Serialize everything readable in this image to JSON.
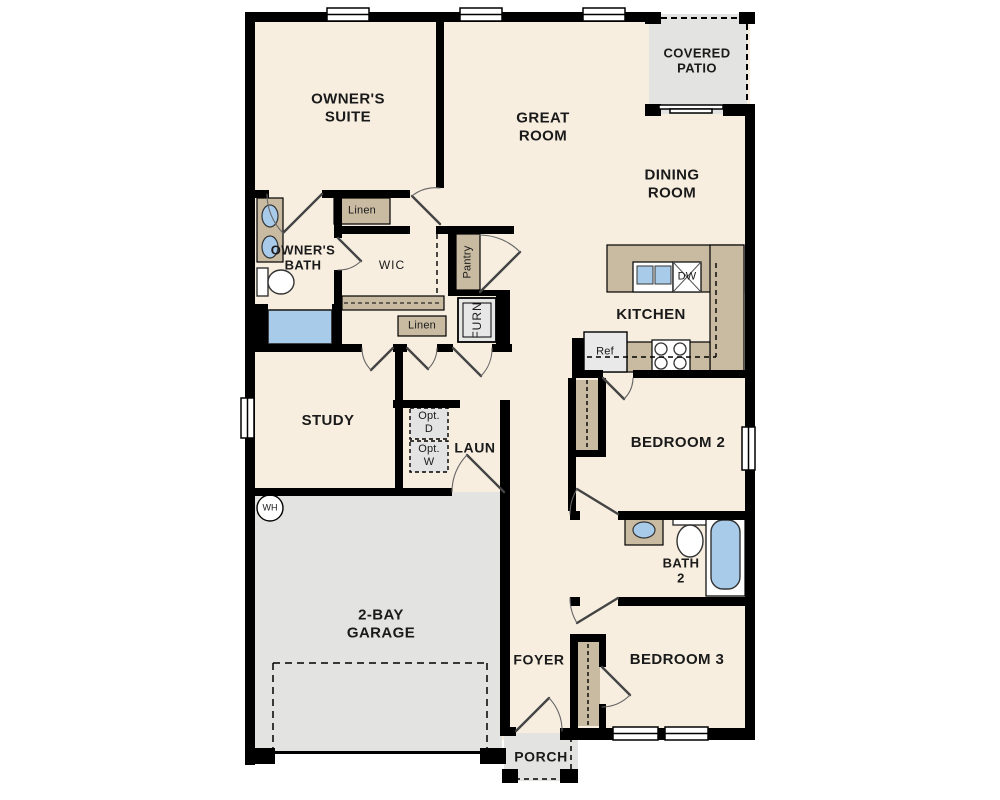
{
  "title": "single-story floor plan",
  "labels": {
    "owners_suite": "OWNER'S\nSUITE",
    "great_room": "GREAT\nROOM",
    "covered_patio": "COVERED\nPATIO",
    "dining_room": "DINING\nROOM",
    "owners_bath": "OWNER'S\nBATH",
    "linen_1": "Linen",
    "wic": "WIC",
    "pantry": "Pantry",
    "furn": "FURN",
    "linen_2": "Linen",
    "kitchen": "KITCHEN",
    "dw": "DW",
    "ref": "Ref",
    "study": "STUDY",
    "opt_d": "Opt.\nD",
    "opt_w": "Opt.\nW",
    "laun": "LAUN",
    "bedroom_2": "BEDROOM 2",
    "wh": "WH",
    "bath_2": "BATH\n2",
    "garage": "2-BAY\nGARAGE",
    "foyer": "FOYER",
    "bedroom_3": "BEDROOM 3",
    "porch": "PORCH"
  },
  "colors": {
    "wall": "#000000",
    "floor": "#f7eee0",
    "outdoor_concrete": "#e3e3e1",
    "cabinet_tan": "#c9bba2",
    "fixture_blue": "#a9cbea",
    "appliance_gray": "#e9e9e9",
    "text": "#1a1a1a"
  }
}
